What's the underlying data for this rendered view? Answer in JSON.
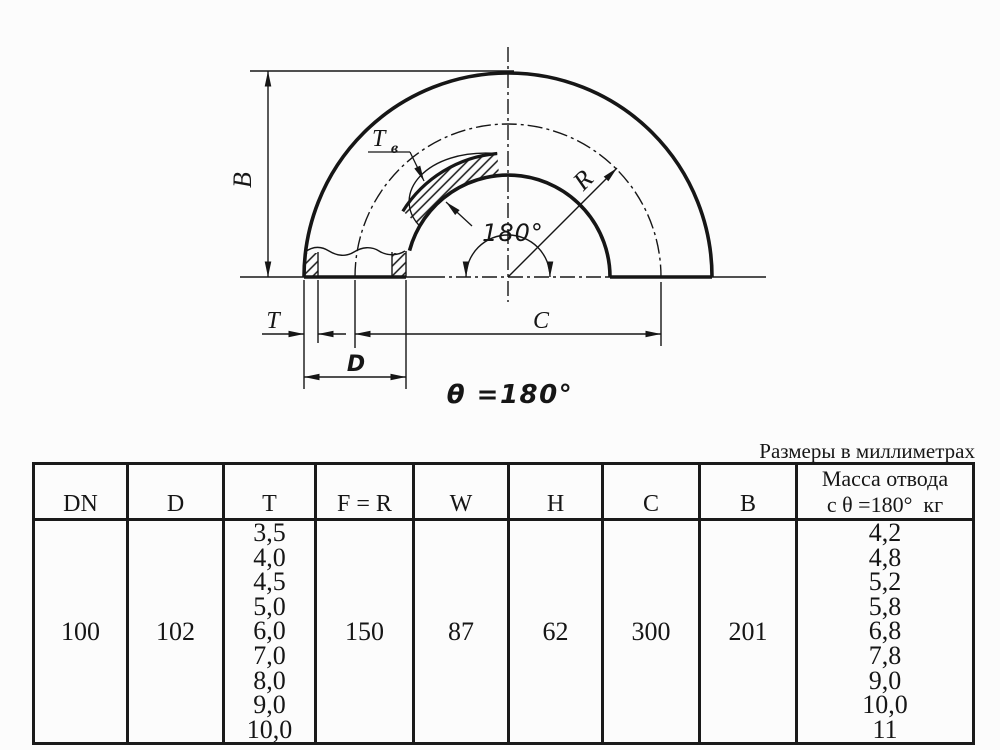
{
  "note_units": "Размеры в миллиметрах",
  "drawing": {
    "dim_B": "B",
    "dim_T": "T",
    "dim_Tb": "Т",
    "dim_Tb_sub": "в",
    "dim_R": "R",
    "angle_label": "180°",
    "dim_C": "C",
    "dim_D": "D",
    "theta_label": "θ =180°"
  },
  "table": {
    "headers": {
      "dn": "DN",
      "d": "D",
      "t": "T",
      "fr": "F = R",
      "w": "W",
      "h": "H",
      "c": "C",
      "b": "B",
      "mass1": "Масса отвода",
      "mass2": "с θ =180°  кг"
    },
    "row": {
      "dn": "100",
      "d": "102",
      "t_values": [
        "3,5",
        "4,0",
        "4,5",
        "5,0",
        "6,0",
        "7,0",
        "8,0",
        "9,0",
        "10,0"
      ],
      "fr": "150",
      "w": "87",
      "h": "62",
      "c": "300",
      "b": "201",
      "mass_values": [
        "4,2",
        "4,8",
        "5,2",
        "5,8",
        "6,8",
        "7,8",
        "9,0",
        "10,0",
        "11"
      ]
    }
  }
}
